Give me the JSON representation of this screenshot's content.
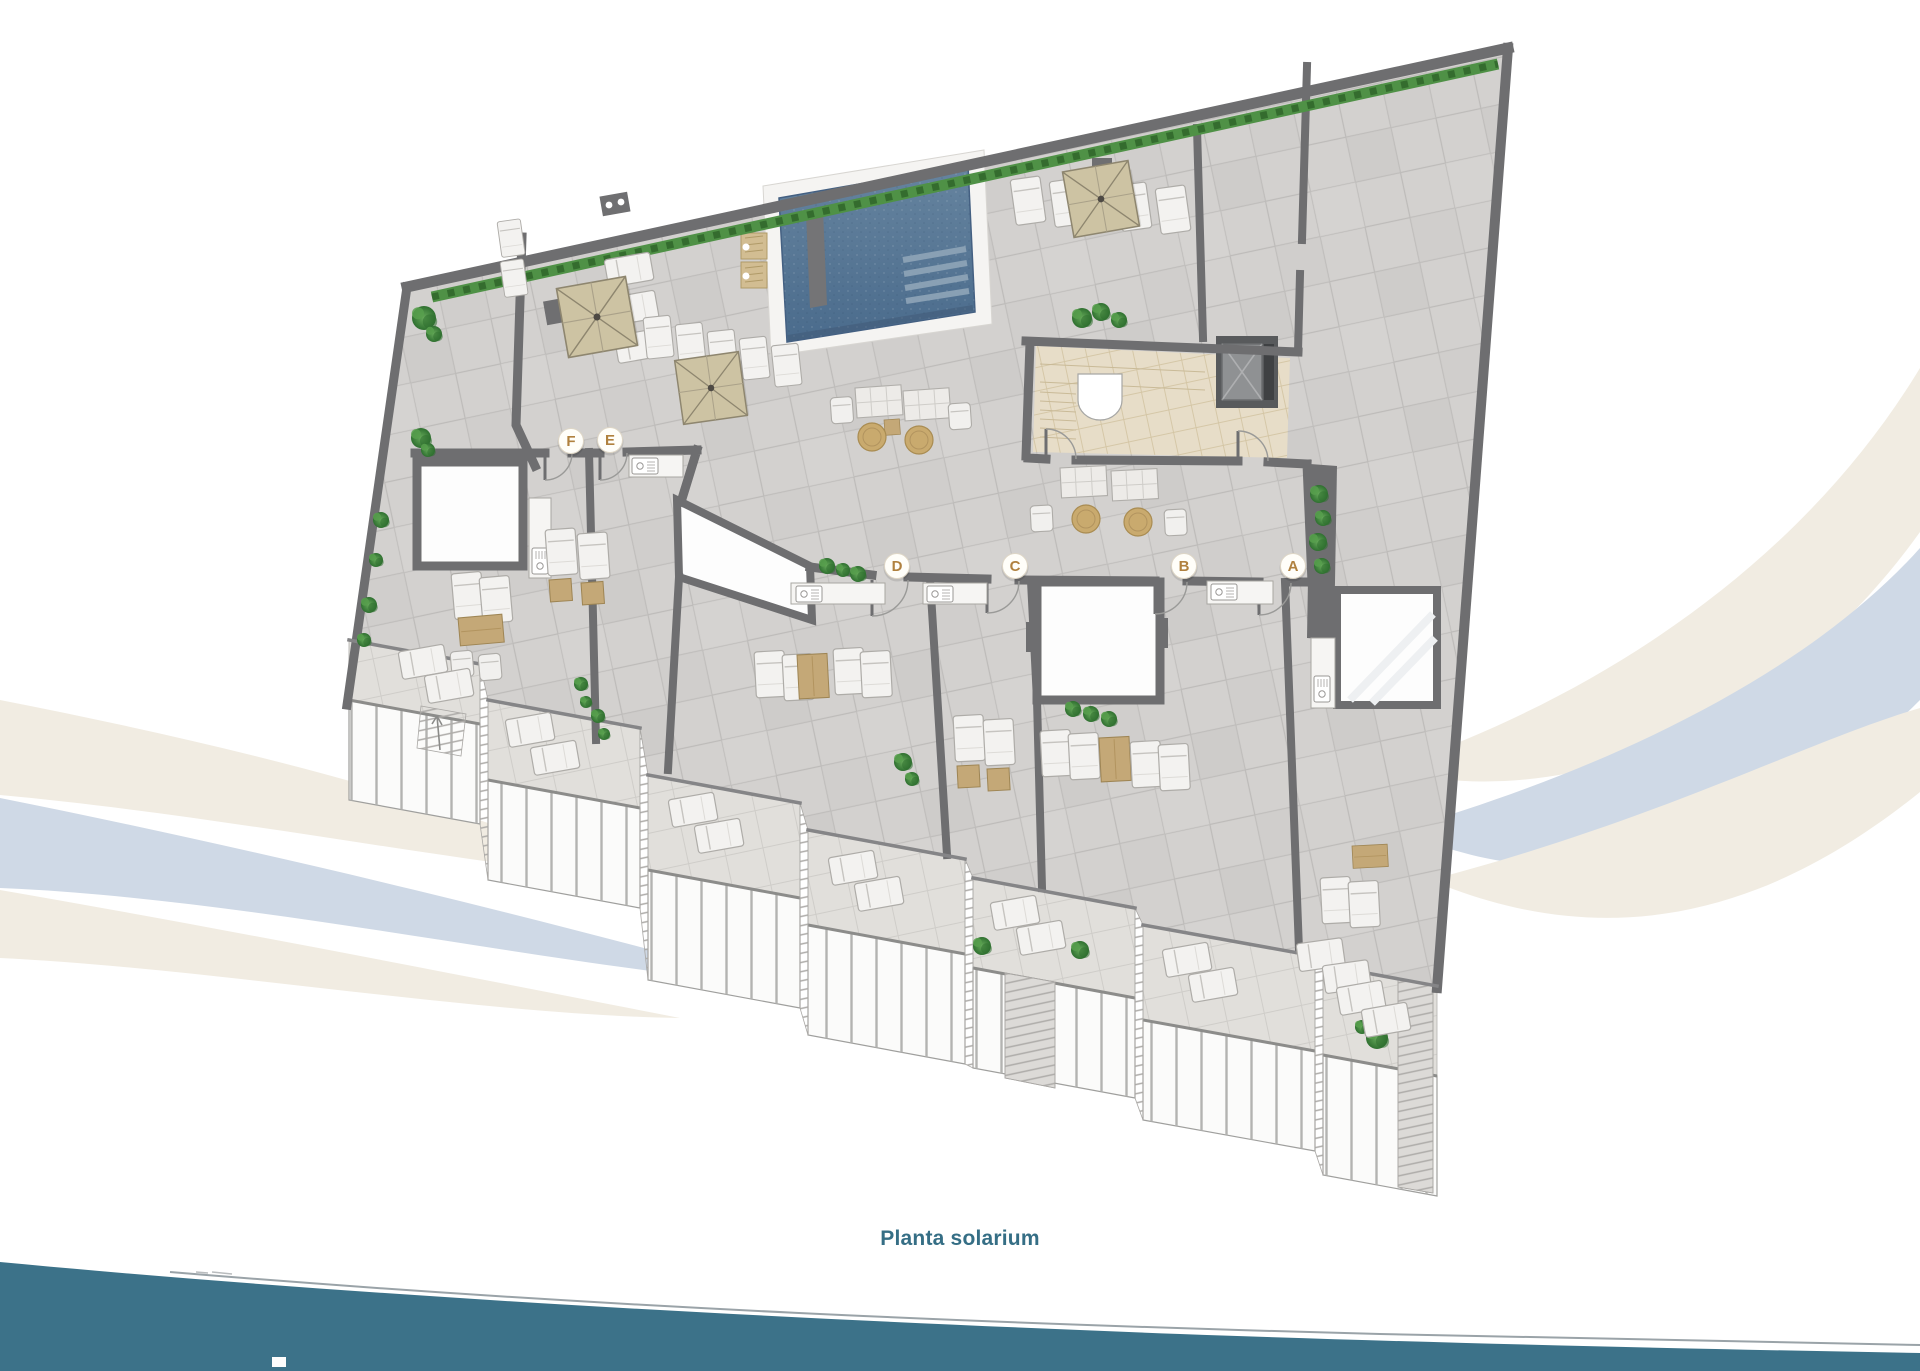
{
  "caption": {
    "text": "Planta solarium"
  },
  "floor_plan": {
    "type": "rooftop-solarium-floor-plan",
    "unit_markers": [
      {
        "label": "F"
      },
      {
        "label": "E"
      },
      {
        "label": "D"
      },
      {
        "label": "C"
      },
      {
        "label": "B"
      },
      {
        "label": "A"
      }
    ]
  },
  "colors": {
    "caption_teal": "#356e85",
    "footer_band_teal": "#3c7289",
    "marker_letter": "#b0813f",
    "marker_circle": "#fffef9",
    "wall_gray": "#6e6e70",
    "floor_tile_gray": "#d3d1cf",
    "terrace_tile_gray": "#e1dfdb",
    "stair_hall_beige": "#e7ddc8",
    "pool_water_blue": "#5b7c9b",
    "pool_deck_white": "#f5f4f2",
    "umbrella_tan": "#cdc3a3",
    "furniture_tan": "#c4a877",
    "plant_green": "#4e9347",
    "railing_white": "#fbfbfa",
    "swoosh_cream": "#f1ece2",
    "swoosh_blue_gray": "#cfd9e6"
  }
}
